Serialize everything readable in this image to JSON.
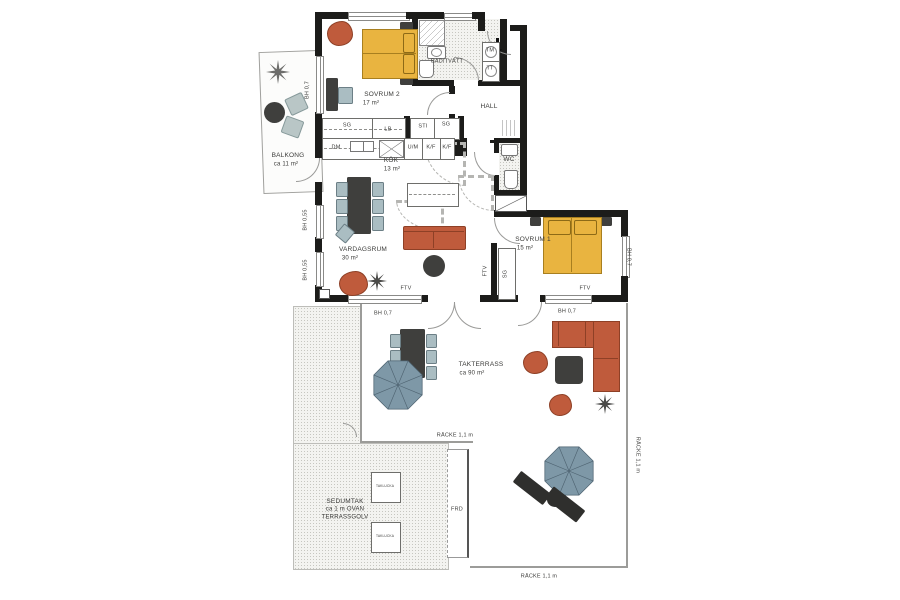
{
  "plan": {
    "texts": {
      "sovrum2": "SOVRUM 2",
      "sovrum2_area": "17 m²",
      "badtvatt": "BAD/TVÄTT",
      "tm": "TM",
      "tt": "TT",
      "hall": "HALL",
      "sg": "SG",
      "lb": "LB",
      "sti": "STI",
      "dm": "DM",
      "um": "U/M",
      "kf": "K/F",
      "kok": "KÖK",
      "kok_area": "13 m²",
      "wc": "WC",
      "balkong": "BALKONG",
      "balkong_area": "ca 11 m²",
      "vardagsrum": "VARDAGSRUM",
      "vardagsrum_area": "30 m²",
      "sovrum1": "SOVRUM 1",
      "sovrum1_area": "15 m²",
      "takterrass": "TAKTERRASS",
      "takterrass_area": "ca 90 m²",
      "frd": "FRD",
      "bh07": "BH 0,7",
      "bh055": "BH 0,55",
      "ftv": "FTV",
      "racke": "RÄCKE 1,1 m",
      "sedumtak1": "SEDUMTAK",
      "sedumtak2": "ca 1 m OVAN",
      "sedumtak3": "TERRASSGOLV",
      "taklucka": "TAKLUCKA"
    },
    "colors": {
      "wall": "#1c1c1a",
      "bed": "#e9b440",
      "terracotta": "#bf5b3c",
      "seat": "#aabdc2",
      "dark_furniture": "#3f3f3d",
      "parasol": "#7e98a7"
    }
  }
}
